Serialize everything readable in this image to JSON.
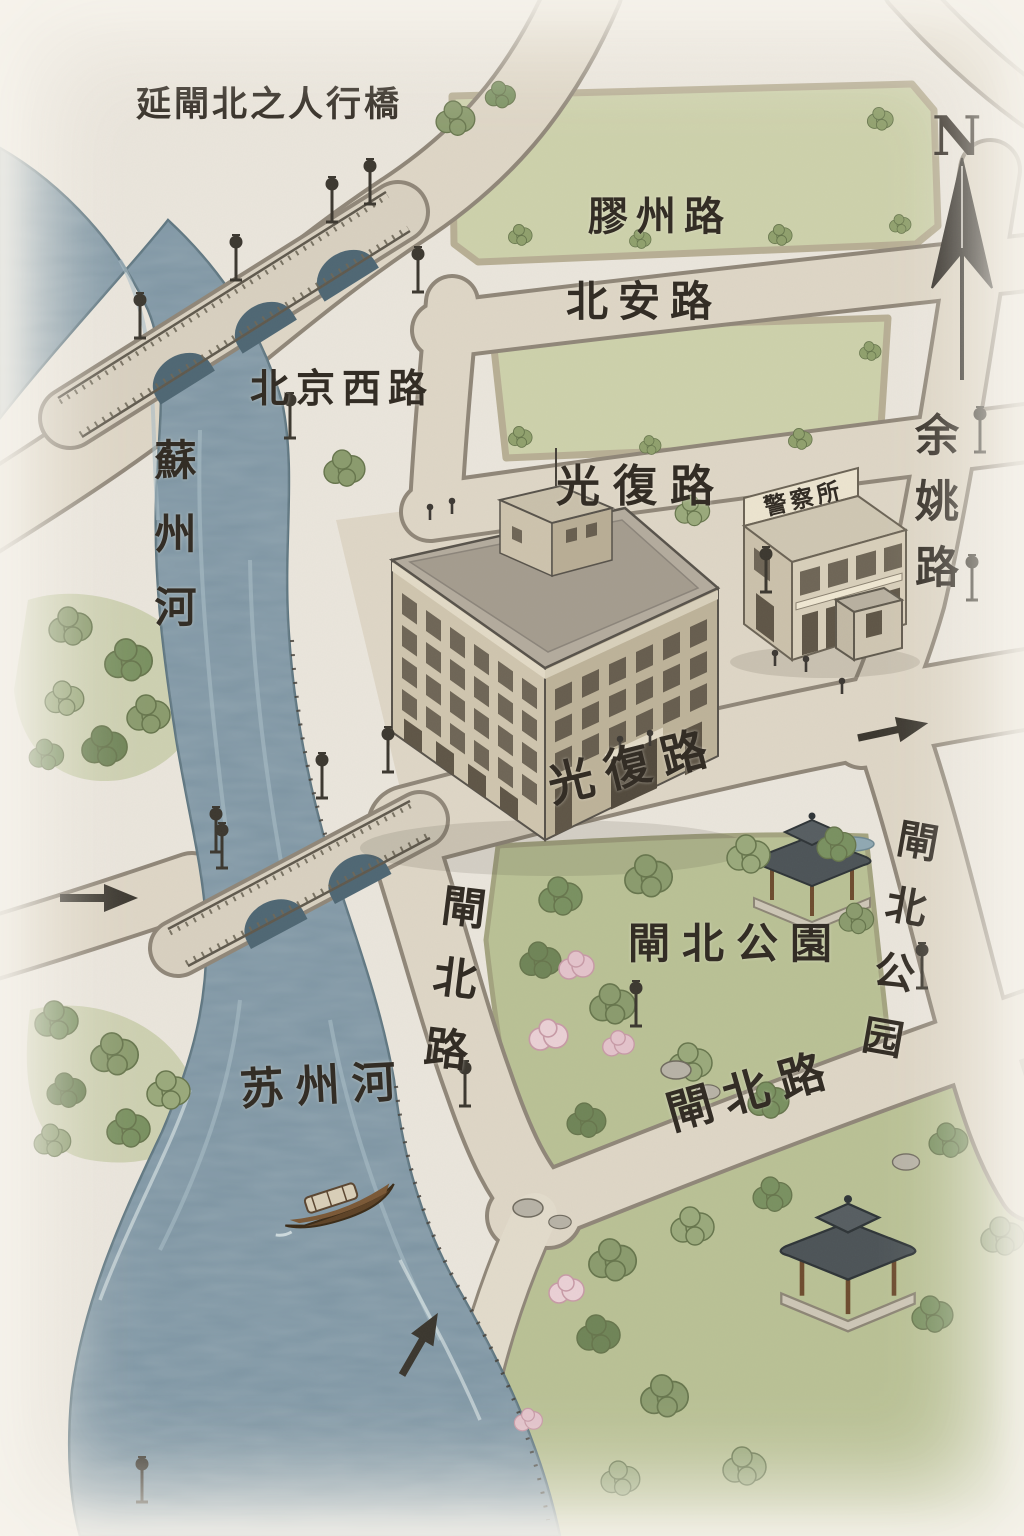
{
  "map": {
    "kind": "hand-drawn isometric street map of the Suzhou Creek / Zhabei area",
    "labels": {
      "pedestrian_bridge": "延閘北之人行橋",
      "jiaozhou_road": "膠州路",
      "beian_road": "北安路",
      "beijing_west_road": "北京西路",
      "guangfu_road_upper": "光復路",
      "suzhou_river_traditional": "蘇州河",
      "yuyao_road": "余姚路",
      "police_station_sign": "警察所",
      "guangfu_road_lower": "光復路",
      "zhabei_road_west": "閘北路",
      "zhabei_park_center": "閘北公園",
      "zhabei_park_east": "閘北公园",
      "suzhou_river_simplified": "苏州河",
      "zhabei_road_south": "閘北路"
    },
    "compass": {
      "north": "N"
    },
    "colors": {
      "paper": "#eae5dc",
      "water": "#7d95a3",
      "water_edge": "#5d7580",
      "road": "#ded6c6",
      "road_edge": "#8f8678",
      "field": "#cdd1ab",
      "park": "#b9c195",
      "ink": "#332d25",
      "building_stone": "#cfc5ae",
      "roof_dark": "#4c5357",
      "wood": "#7a5836"
    },
    "illustrations": [
      "stone-arch-bridge-north",
      "stone-arch-bridge-south",
      "warehouse-building",
      "police-station-building",
      "guard-booth",
      "park-pavilion",
      "riverside-pavilion",
      "wooden-boat",
      "street-lamp",
      "road-direction-arrow",
      "north-compass-needle",
      "trees",
      "blossom-trees",
      "rocks",
      "pedestrians"
    ]
  }
}
